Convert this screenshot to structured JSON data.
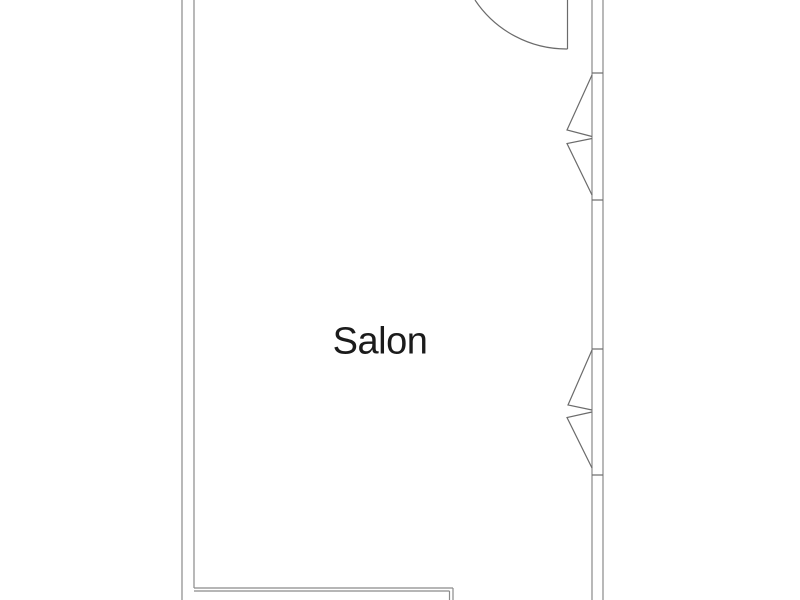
{
  "canvas": {
    "width": 800,
    "height": 600,
    "background": "#ffffff"
  },
  "colors": {
    "wall": "#8a8a8a",
    "detail": "#6b6b6b",
    "text": "#1b1b1b"
  },
  "room": {
    "label": "Salon",
    "label_x": 380,
    "label_y": 342,
    "label_font_size": 38
  },
  "floorplan": {
    "walls": [
      {
        "name": "left-wall-outer-line",
        "x1": 182,
        "y1": 0,
        "x2": 182,
        "y2": 600
      },
      {
        "name": "left-wall-inner-line",
        "x1": 194,
        "y1": 0,
        "x2": 194,
        "y2": 588
      },
      {
        "name": "right-wall-inner-line",
        "x1": 592,
        "y1": 0,
        "x2": 592,
        "y2": 600
      },
      {
        "name": "right-wall-outer-line",
        "x1": 603,
        "y1": 0,
        "x2": 603,
        "y2": 600
      },
      {
        "name": "bottom-partition-top-line",
        "x1": 194,
        "y1": 588,
        "x2": 453,
        "y2": 588
      },
      {
        "name": "bottom-partition-bottom-line",
        "x1": 194,
        "y1": 591,
        "x2": 449.5,
        "y2": 591
      },
      {
        "name": "bottom-partition-end-outer",
        "x1": 453,
        "y1": 588,
        "x2": 453,
        "y2": 600
      },
      {
        "name": "bottom-partition-end-inner",
        "x1": 449.5,
        "y1": 591,
        "x2": 449.5,
        "y2": 600
      }
    ],
    "door": {
      "leaf": {
        "name": "door-leaf",
        "x1": 567.5,
        "y1": 0,
        "x2": 567.5,
        "y2": 49
      },
      "arc": {
        "name": "door-swing-arc",
        "path": "M 475 0 A 110 110 0 0 0 567.5 49"
      }
    },
    "windows": [
      {
        "name": "window-top",
        "ticks": [
          {
            "name": "window-frame-tick",
            "x1": 592,
            "y1": 73,
            "x2": 603,
            "y2": 73
          },
          {
            "name": "window-frame-tick",
            "x1": 592,
            "y1": 200,
            "x2": 603,
            "y2": 200
          }
        ],
        "sashes": [
          {
            "name": "window-sash-triangle",
            "points": [
              [
                592,
                75
              ],
              [
                567,
                130
              ],
              [
                592,
                136.5
              ]
            ]
          },
          {
            "name": "window-sash-triangle",
            "points": [
              [
                592,
                138.5
              ],
              [
                567,
                143.5
              ],
              [
                592,
                195
              ]
            ]
          }
        ]
      },
      {
        "name": "window-bottom",
        "ticks": [
          {
            "name": "window-frame-tick",
            "x1": 592,
            "y1": 349,
            "x2": 603,
            "y2": 349
          },
          {
            "name": "window-frame-tick",
            "x1": 592,
            "y1": 475,
            "x2": 603,
            "y2": 475
          }
        ],
        "sashes": [
          {
            "name": "window-sash-triangle",
            "points": [
              [
                592,
                350
              ],
              [
                568,
                405
              ],
              [
                592,
                410
              ]
            ]
          },
          {
            "name": "window-sash-triangle",
            "points": [
              [
                592,
                412
              ],
              [
                567,
                417.5
              ],
              [
                592,
                468
              ]
            ]
          }
        ]
      }
    ]
  }
}
